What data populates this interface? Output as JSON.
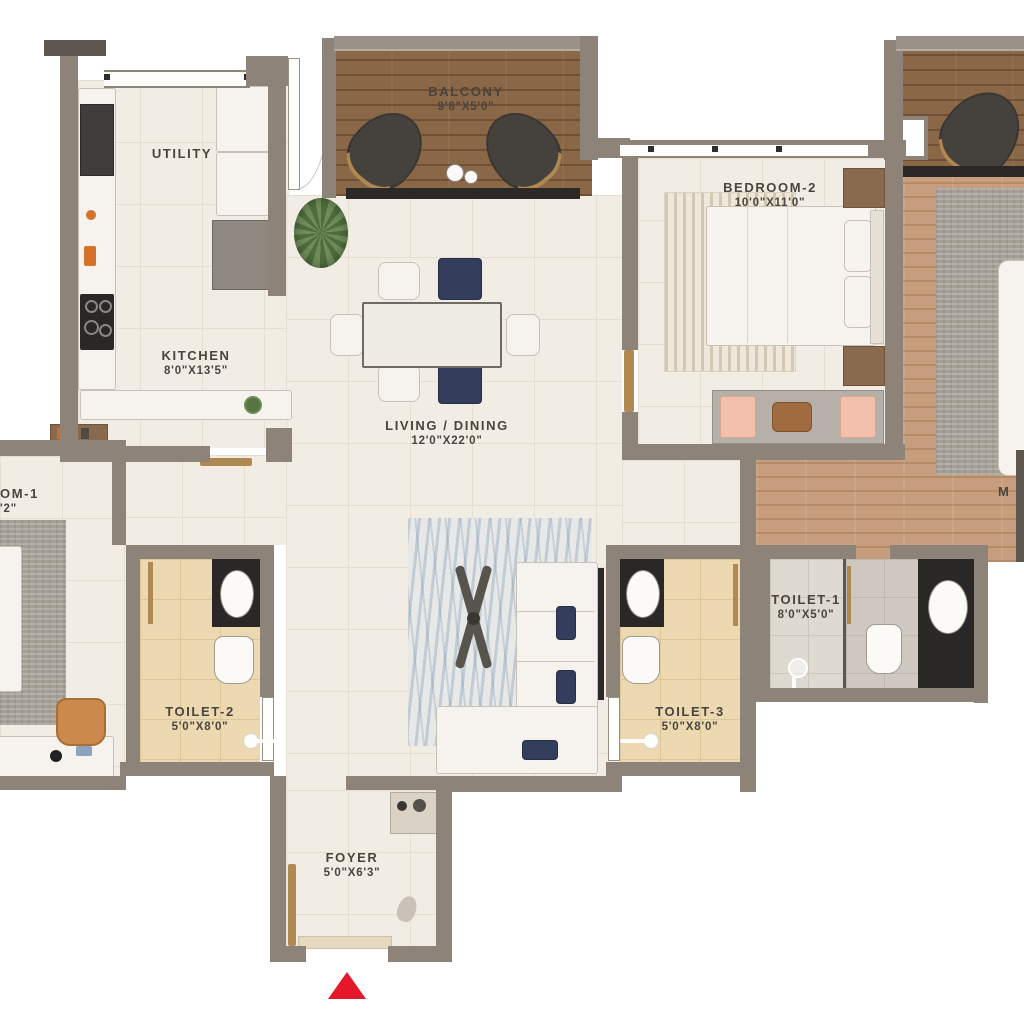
{
  "title": "Apartment Floor Plan",
  "rooms": {
    "balcony": {
      "label": "BALCONY",
      "dims": "9'8\"X5'0\""
    },
    "utility": {
      "label": "UTILITY"
    },
    "kitchen": {
      "label": "KITCHEN",
      "dims": "8'0\"X13'5\""
    },
    "bedroom2": {
      "label": "BEDROOM-2",
      "dims": "10'0\"X11'0\""
    },
    "living": {
      "label": "LIVING / DINING",
      "dims": "12'0\"X22'0\""
    },
    "toilet1": {
      "label": "TOILET-1",
      "dims": "8'0\"X5'0\""
    },
    "toilet2": {
      "label": "TOILET-2",
      "dims": "5'0\"X8'0\""
    },
    "toilet3": {
      "label": "TOILET-3",
      "dims": "5'0\"X8'0\""
    },
    "foyer": {
      "label": "FOYER",
      "dims": "5'0\"X6'3\""
    },
    "bedroom1_cut": {
      "label": "OM-1",
      "dims": "'2\""
    },
    "master_cut": {
      "label": "M"
    }
  },
  "colors": {
    "entrance_arrow": "#e5172b",
    "wall": "#8d8379",
    "floor_tile": "#f2ede4",
    "balcony_wood": "#8a6747",
    "master_wood": "#c79e7d",
    "toilet_tile": "#ecd9b2",
    "accent_navy": "#333d5c",
    "accent_pink": "#f2c0ad",
    "accent_brass": "#b08952"
  }
}
